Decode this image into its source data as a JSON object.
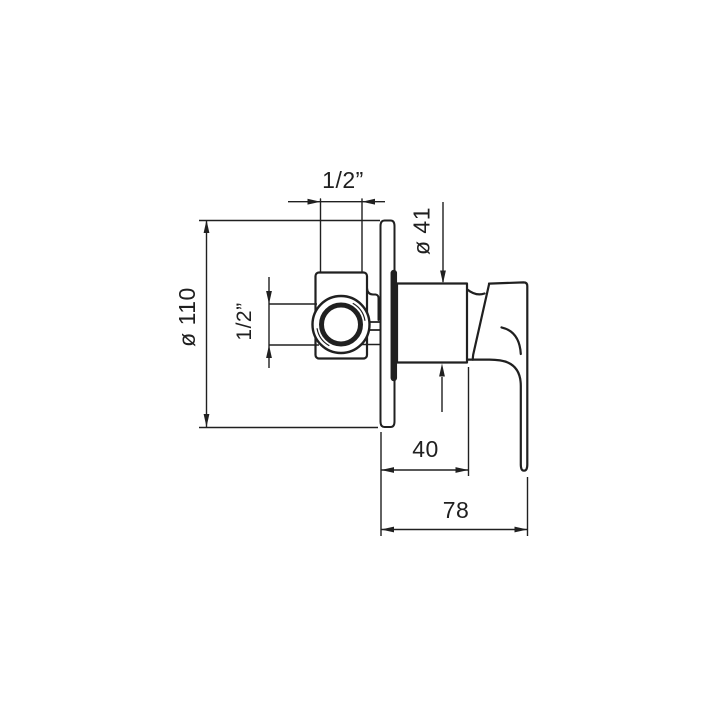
{
  "page": {
    "background": "#ffffff",
    "line_color": "#202020"
  },
  "drawing": {
    "type": "technical-dimension-drawing",
    "subject": "concealed single-lever shower mixer valve, side elevation",
    "dimensions": {
      "top_inlet_thread": "1/2”",
      "side_port_thread": "1/2”",
      "body_diameter": "ø 41",
      "escutcheon_diameter": "ø 110",
      "body_depth": "40",
      "overall_depth": "78"
    }
  }
}
